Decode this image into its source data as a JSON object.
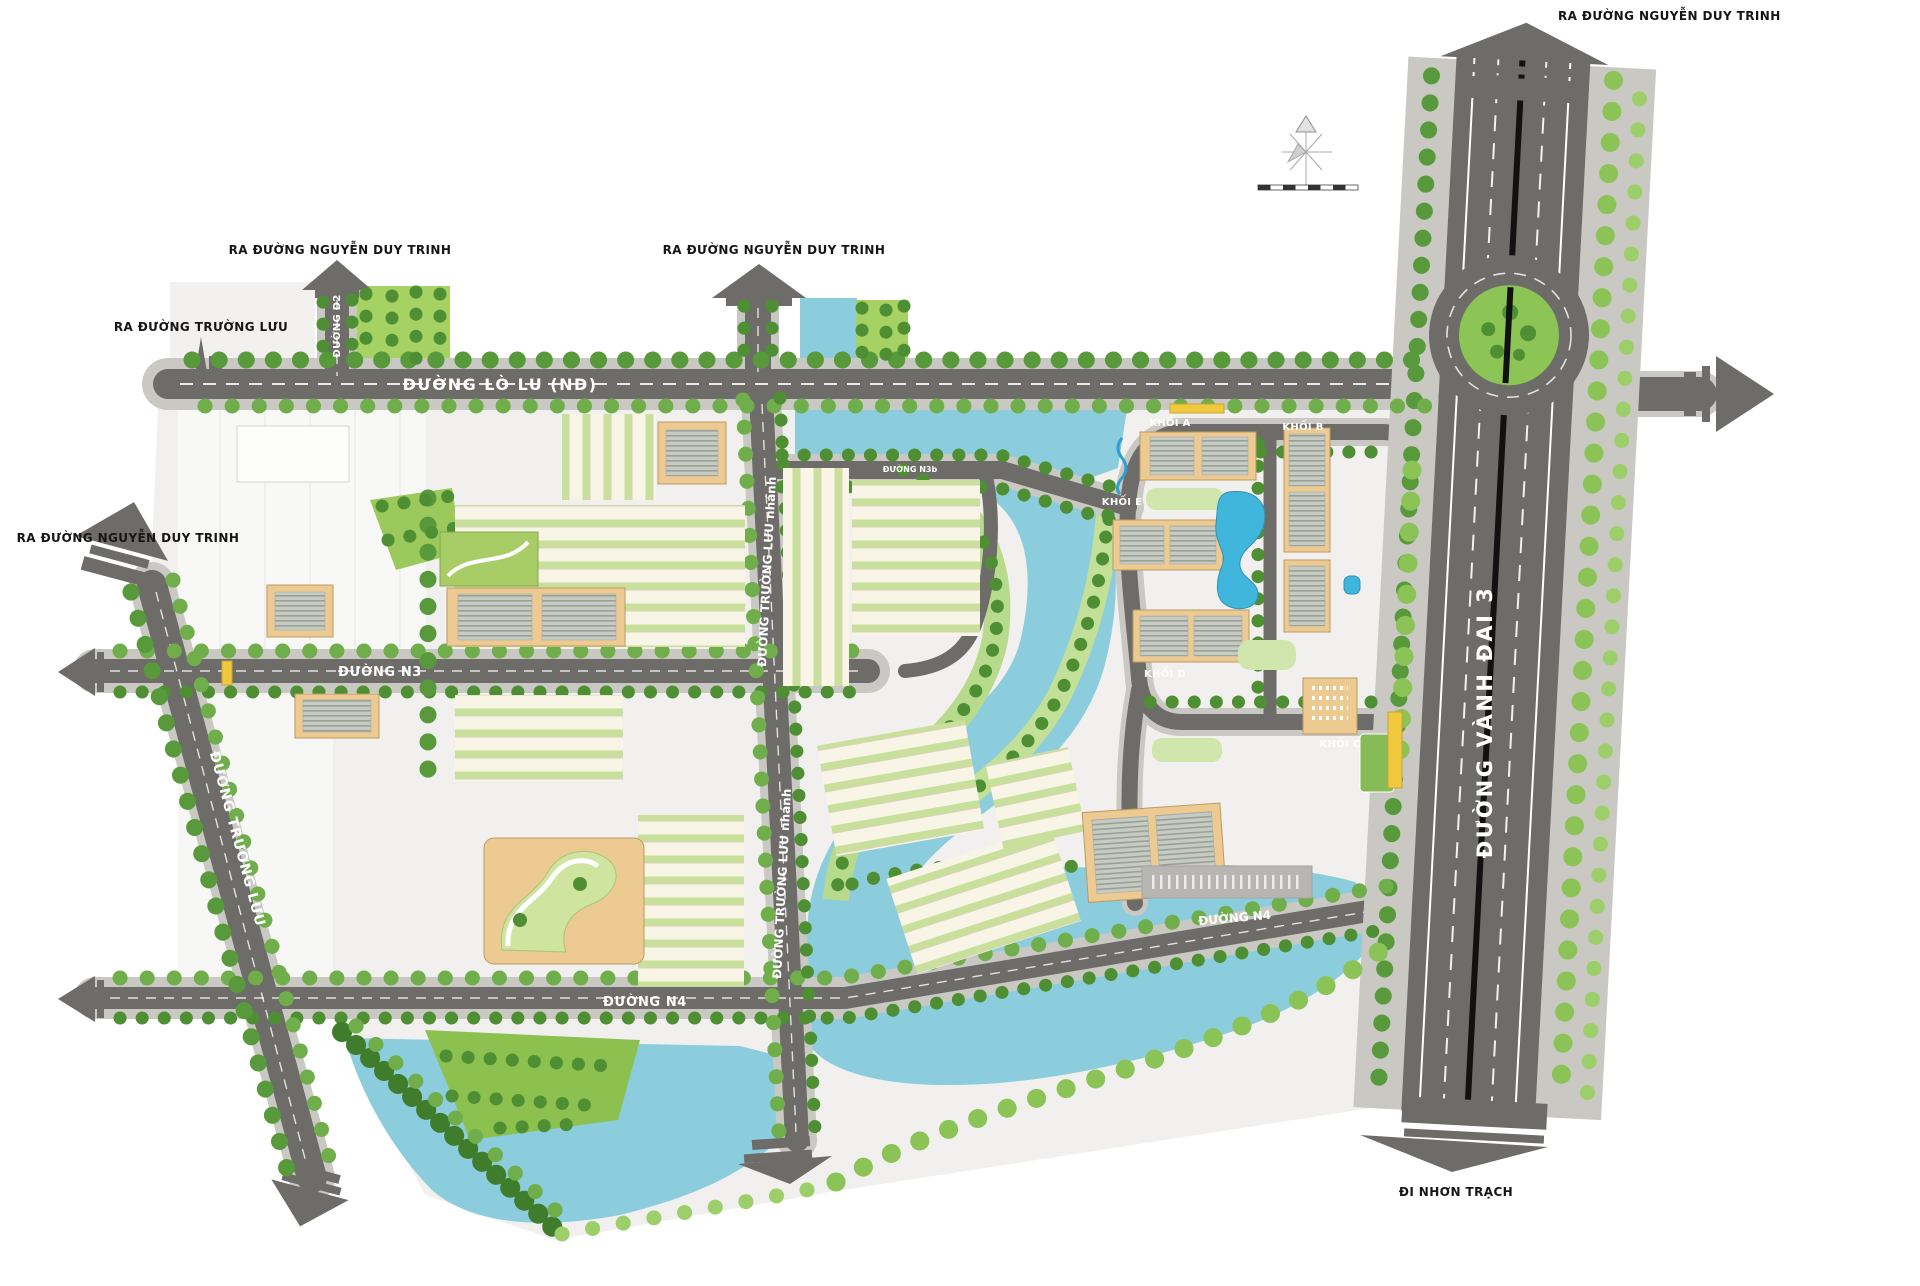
{
  "map": {
    "title": "Master plan – residential area site map",
    "labels": {
      "exit_nguyen_duy_trinh": "RA ĐƯỜNG NGUYỄN DUY TRINH",
      "exit_truong_luu": "RA ĐƯỜNG TRƯỜNG LƯU",
      "exit_nhon_trach": "ĐI NHƠN TRẠCH"
    },
    "roads": {
      "lo_lu": "ĐƯỜNG LÒ LU (ND)",
      "vanh_dai_3": "ĐƯỜNG VÀNH ĐAI 3",
      "d2": "ĐƯỜNG D2",
      "truong_luu": "ĐƯỜNG TRƯỜNG LƯU",
      "truong_luu_nhanh": "ĐƯỜNG TRƯỜNG LƯU nhánh",
      "n3": "ĐƯỜNG N3",
      "n3b": "ĐƯỜNG N3b",
      "n4": "ĐƯỜNG N4"
    },
    "blocks": {
      "khoi_a": "KHỐI A",
      "khoi_b": "KHỐI B",
      "khoi_c": "KHỐI C",
      "khoi_d": "KHỐI D",
      "khoi_e": "KHỐI E"
    },
    "colors": {
      "road": "#6e6c69",
      "pavement": "#c9c8c3",
      "water": "#8bcddd",
      "pool": "#41b6dc",
      "tree": "#57993b",
      "palm": "#8cc356",
      "grass": "#a6d163",
      "building_tan": "#ecca92",
      "townhouse": "#f8f4e6",
      "highlight_yellow": "#f0c93f",
      "land": "#f1f0ee"
    }
  }
}
